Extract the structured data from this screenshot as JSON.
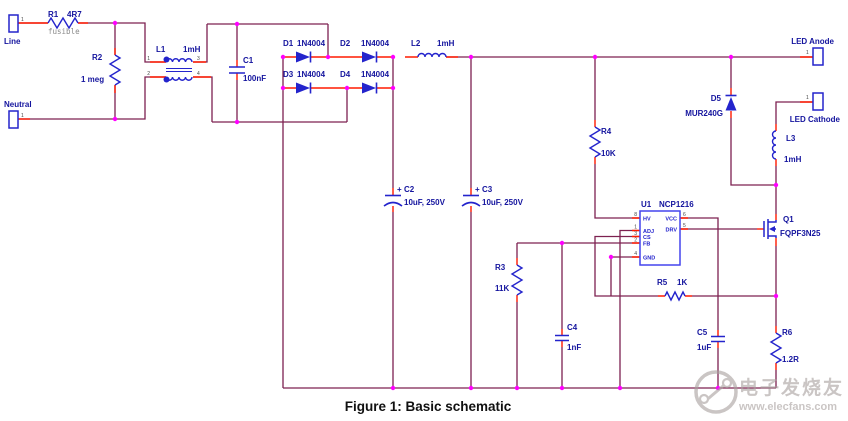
{
  "schematic": {
    "caption": "Figure 1: Basic schematic",
    "connectors": {
      "line": {
        "label": "Line",
        "pin": "1"
      },
      "neutral": {
        "label": "Neutral",
        "pin": "1"
      },
      "led_anode": {
        "label": "LED Anode",
        "pin": "1"
      },
      "led_cathode": {
        "label": "LED Cathode",
        "pin": "1"
      }
    },
    "components": {
      "r1": {
        "ref": "R1",
        "value": "4R7",
        "note": "fusible"
      },
      "r2": {
        "ref": "R2",
        "value": "1 meg"
      },
      "r3": {
        "ref": "R3",
        "value": "11K"
      },
      "r4": {
        "ref": "R4",
        "value": "10K"
      },
      "r5": {
        "ref": "R5",
        "value": "1K"
      },
      "r6": {
        "ref": "R6",
        "value": "1.2R"
      },
      "c1": {
        "ref": "C1",
        "value": "100nF"
      },
      "c2": {
        "ref": "C2",
        "value": "10uF, 250V",
        "polarity": "+"
      },
      "c3": {
        "ref": "C3",
        "value": "10uF, 250V",
        "polarity": "+"
      },
      "c4": {
        "ref": "C4",
        "value": "1nF"
      },
      "c5": {
        "ref": "C5",
        "value": "1uF"
      },
      "l1": {
        "ref": "L1",
        "value": "1mH",
        "pin_numbers": {
          "p1": "1",
          "p2": "2",
          "p3": "3",
          "p4": "4"
        }
      },
      "l2": {
        "ref": "L2",
        "value": "1mH"
      },
      "l3": {
        "ref": "L3",
        "value": "1mH"
      },
      "d1": {
        "ref": "D1",
        "value": "1N4004"
      },
      "d2": {
        "ref": "D2",
        "value": "1N4004"
      },
      "d3": {
        "ref": "D3",
        "value": "1N4004"
      },
      "d4": {
        "ref": "D4",
        "value": "1N4004"
      },
      "d5": {
        "ref": "D5",
        "value": "MUR240G"
      },
      "q1": {
        "ref": "Q1",
        "value": "FQPF3N25"
      },
      "u1": {
        "ref": "U1",
        "value": "NCP1216",
        "pins": {
          "hv": "HV",
          "adj": "ADJ",
          "cs": "CS",
          "fb": "FB",
          "gnd": "GND",
          "vcc": "VCC",
          "drv": "DRV"
        },
        "pin_numbers": {
          "hv": "8",
          "adj": "1",
          "cs": "3",
          "fb": "2",
          "gnd": "4",
          "vcc": "6",
          "drv": "5"
        }
      }
    },
    "colors": {
      "wire": "#7d2150",
      "lead": "#ff1a00",
      "junction": "#ff00ff",
      "component": "#2424cc",
      "label": "#14149e",
      "ic_border": "#4444ee",
      "pin_number": "#444444",
      "note": "#8a8a8a",
      "watermark": "#a8a09e"
    },
    "watermark": {
      "text": "电子发烧友",
      "url": "www.elecfans.com"
    }
  }
}
